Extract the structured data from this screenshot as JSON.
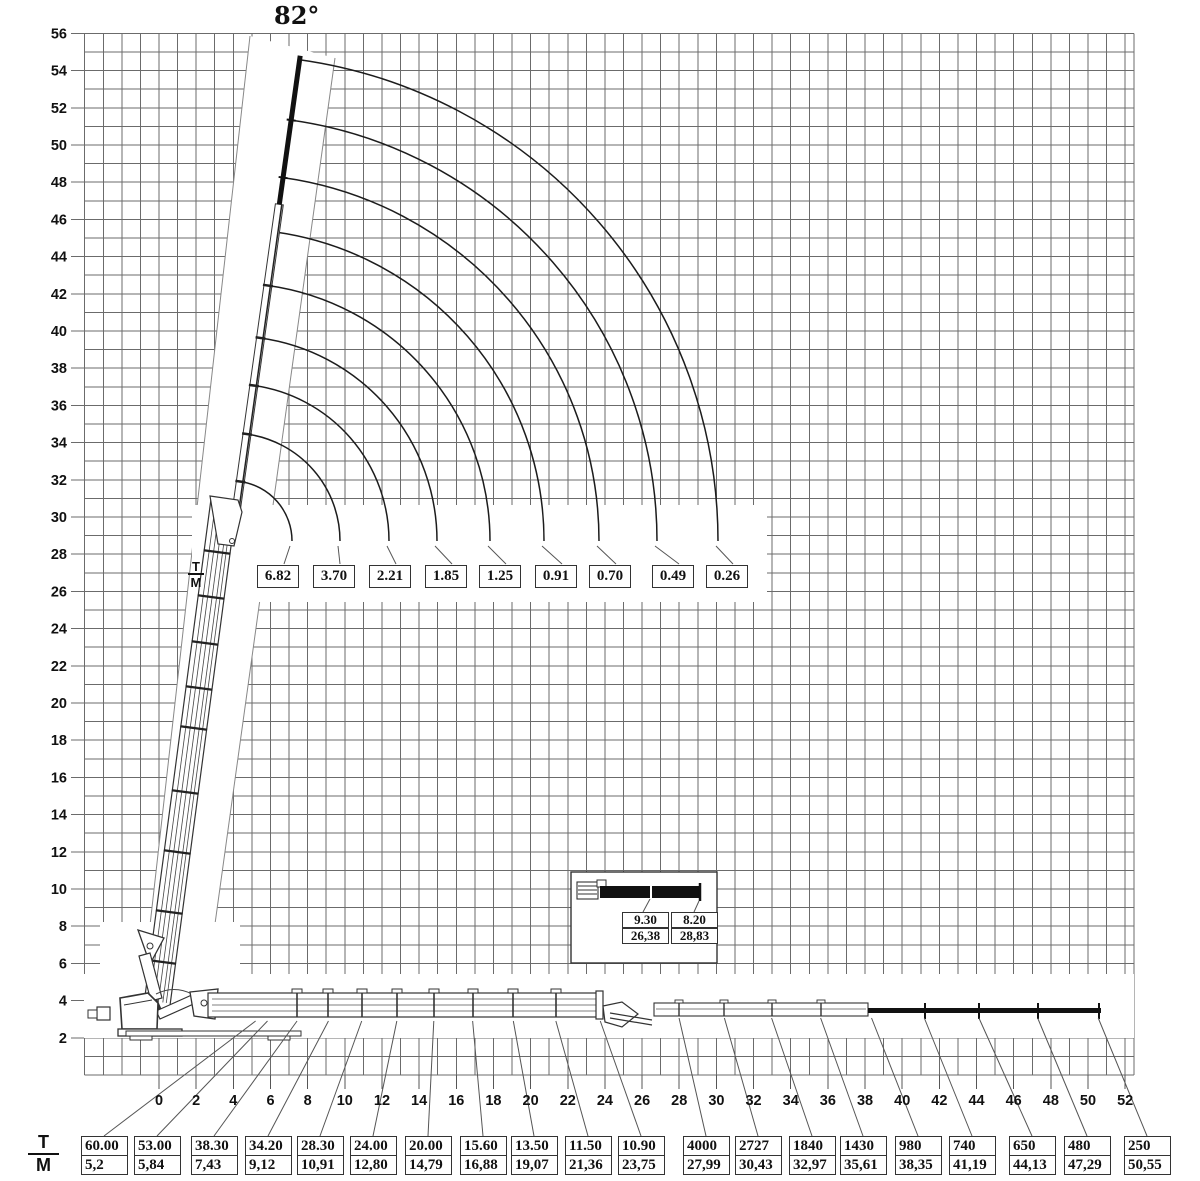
{
  "angle_label": "82°",
  "fraction": {
    "top": "T",
    "bottom": "M"
  },
  "axes": {
    "x_ticks": [
      "0",
      "2",
      "4",
      "6",
      "8",
      "10",
      "12",
      "14",
      "16",
      "18",
      "20",
      "22",
      "24",
      "26",
      "28",
      "30",
      "32",
      "34",
      "36",
      "38",
      "40",
      "42",
      "44",
      "46",
      "48",
      "50",
      "52"
    ],
    "y_ticks": [
      "2",
      "4",
      "6",
      "8",
      "10",
      "12",
      "14",
      "16",
      "18",
      "20",
      "22",
      "24",
      "26",
      "28",
      "30",
      "32",
      "34",
      "36",
      "38",
      "40",
      "42",
      "44",
      "46",
      "48",
      "50",
      "52",
      "54",
      "56"
    ]
  },
  "jib_loads": [
    "6.82",
    "3.70",
    "2.21",
    "1.85",
    "1.25",
    "0.91",
    "0.70",
    "0.49",
    "0.26"
  ],
  "inset": {
    "cells": [
      {
        "load": "9.30",
        "reach": "26,38"
      },
      {
        "load": "8.20",
        "reach": "28,83"
      }
    ]
  },
  "table": {
    "loads": [
      "60.00",
      "53.00",
      "38.30",
      "34.20",
      "28.30",
      "24.00",
      "20.00",
      "15.60",
      "13.50",
      "11.50",
      "10.90",
      "4000",
      "2727",
      "1840",
      "1430",
      "980",
      "740",
      "650",
      "480",
      "250"
    ],
    "reaches": [
      "5,2",
      "5,84",
      "7,43",
      "9,12",
      "10,91",
      "12,80",
      "14,79",
      "16,88",
      "19,07",
      "21,36",
      "23,75",
      "27,99",
      "30,43",
      "32,97",
      "35,61",
      "38,35",
      "41,19",
      "44,13",
      "47,29",
      "50,55"
    ],
    "reach_m": [
      5.2,
      5.84,
      7.43,
      9.12,
      10.91,
      12.8,
      14.79,
      16.88,
      19.07,
      21.36,
      23.75,
      27.99,
      30.43,
      32.97,
      35.61,
      38.35,
      41.19,
      44.13,
      47.29,
      50.55
    ]
  },
  "chart_data": {
    "type": "table",
    "title": "Crane lifting capacity / working range diagram",
    "boom_angle_deg": 82,
    "x_axis": {
      "unit": "m",
      "range": [
        -4,
        52.5
      ],
      "tick_step": 2,
      "first_label": 0,
      "last_label": 52
    },
    "y_axis": {
      "unit": "m",
      "range": [
        0,
        56
      ],
      "tick_step": 2,
      "first_label": 2,
      "last_label": 56
    },
    "grid": true,
    "legend": "T = load, M = outreach in metres; first 11 loads in tonnes, last 9 loads in kg",
    "series": [
      {
        "name": "Jib capacities with boom at 82° (tonnes)",
        "values_t": [
          6.82,
          3.7,
          2.21,
          1.85,
          1.25,
          0.91,
          0.7,
          0.49,
          0.26
        ],
        "outreach_m_est": [
          7.2,
          9.7,
          12.4,
          15.0,
          17.8,
          20.7,
          23.7,
          26.8,
          30.1
        ]
      },
      {
        "name": "Jib detail (inset)",
        "points": [
          {
            "load_t": 9.3,
            "outreach_m": 26.38
          },
          {
            "load_t": 8.2,
            "outreach_m": 28.83
          }
        ]
      },
      {
        "name": "Horizontal boom capacities",
        "load_unit_first11": "t",
        "load_unit_last9": "kg",
        "loads": [
          60.0,
          53.0,
          38.3,
          34.2,
          28.3,
          24.0,
          20.0,
          15.6,
          13.5,
          11.5,
          10.9,
          4000,
          2727,
          1840,
          1430,
          980,
          740,
          650,
          480,
          250
        ],
        "outreach_m": [
          5.2,
          5.84,
          7.43,
          9.12,
          10.91,
          12.8,
          14.79,
          16.88,
          19.07,
          21.36,
          23.75,
          27.99,
          30.43,
          32.97,
          35.61,
          38.35,
          41.19,
          44.13,
          47.29,
          50.55
        ]
      }
    ]
  }
}
